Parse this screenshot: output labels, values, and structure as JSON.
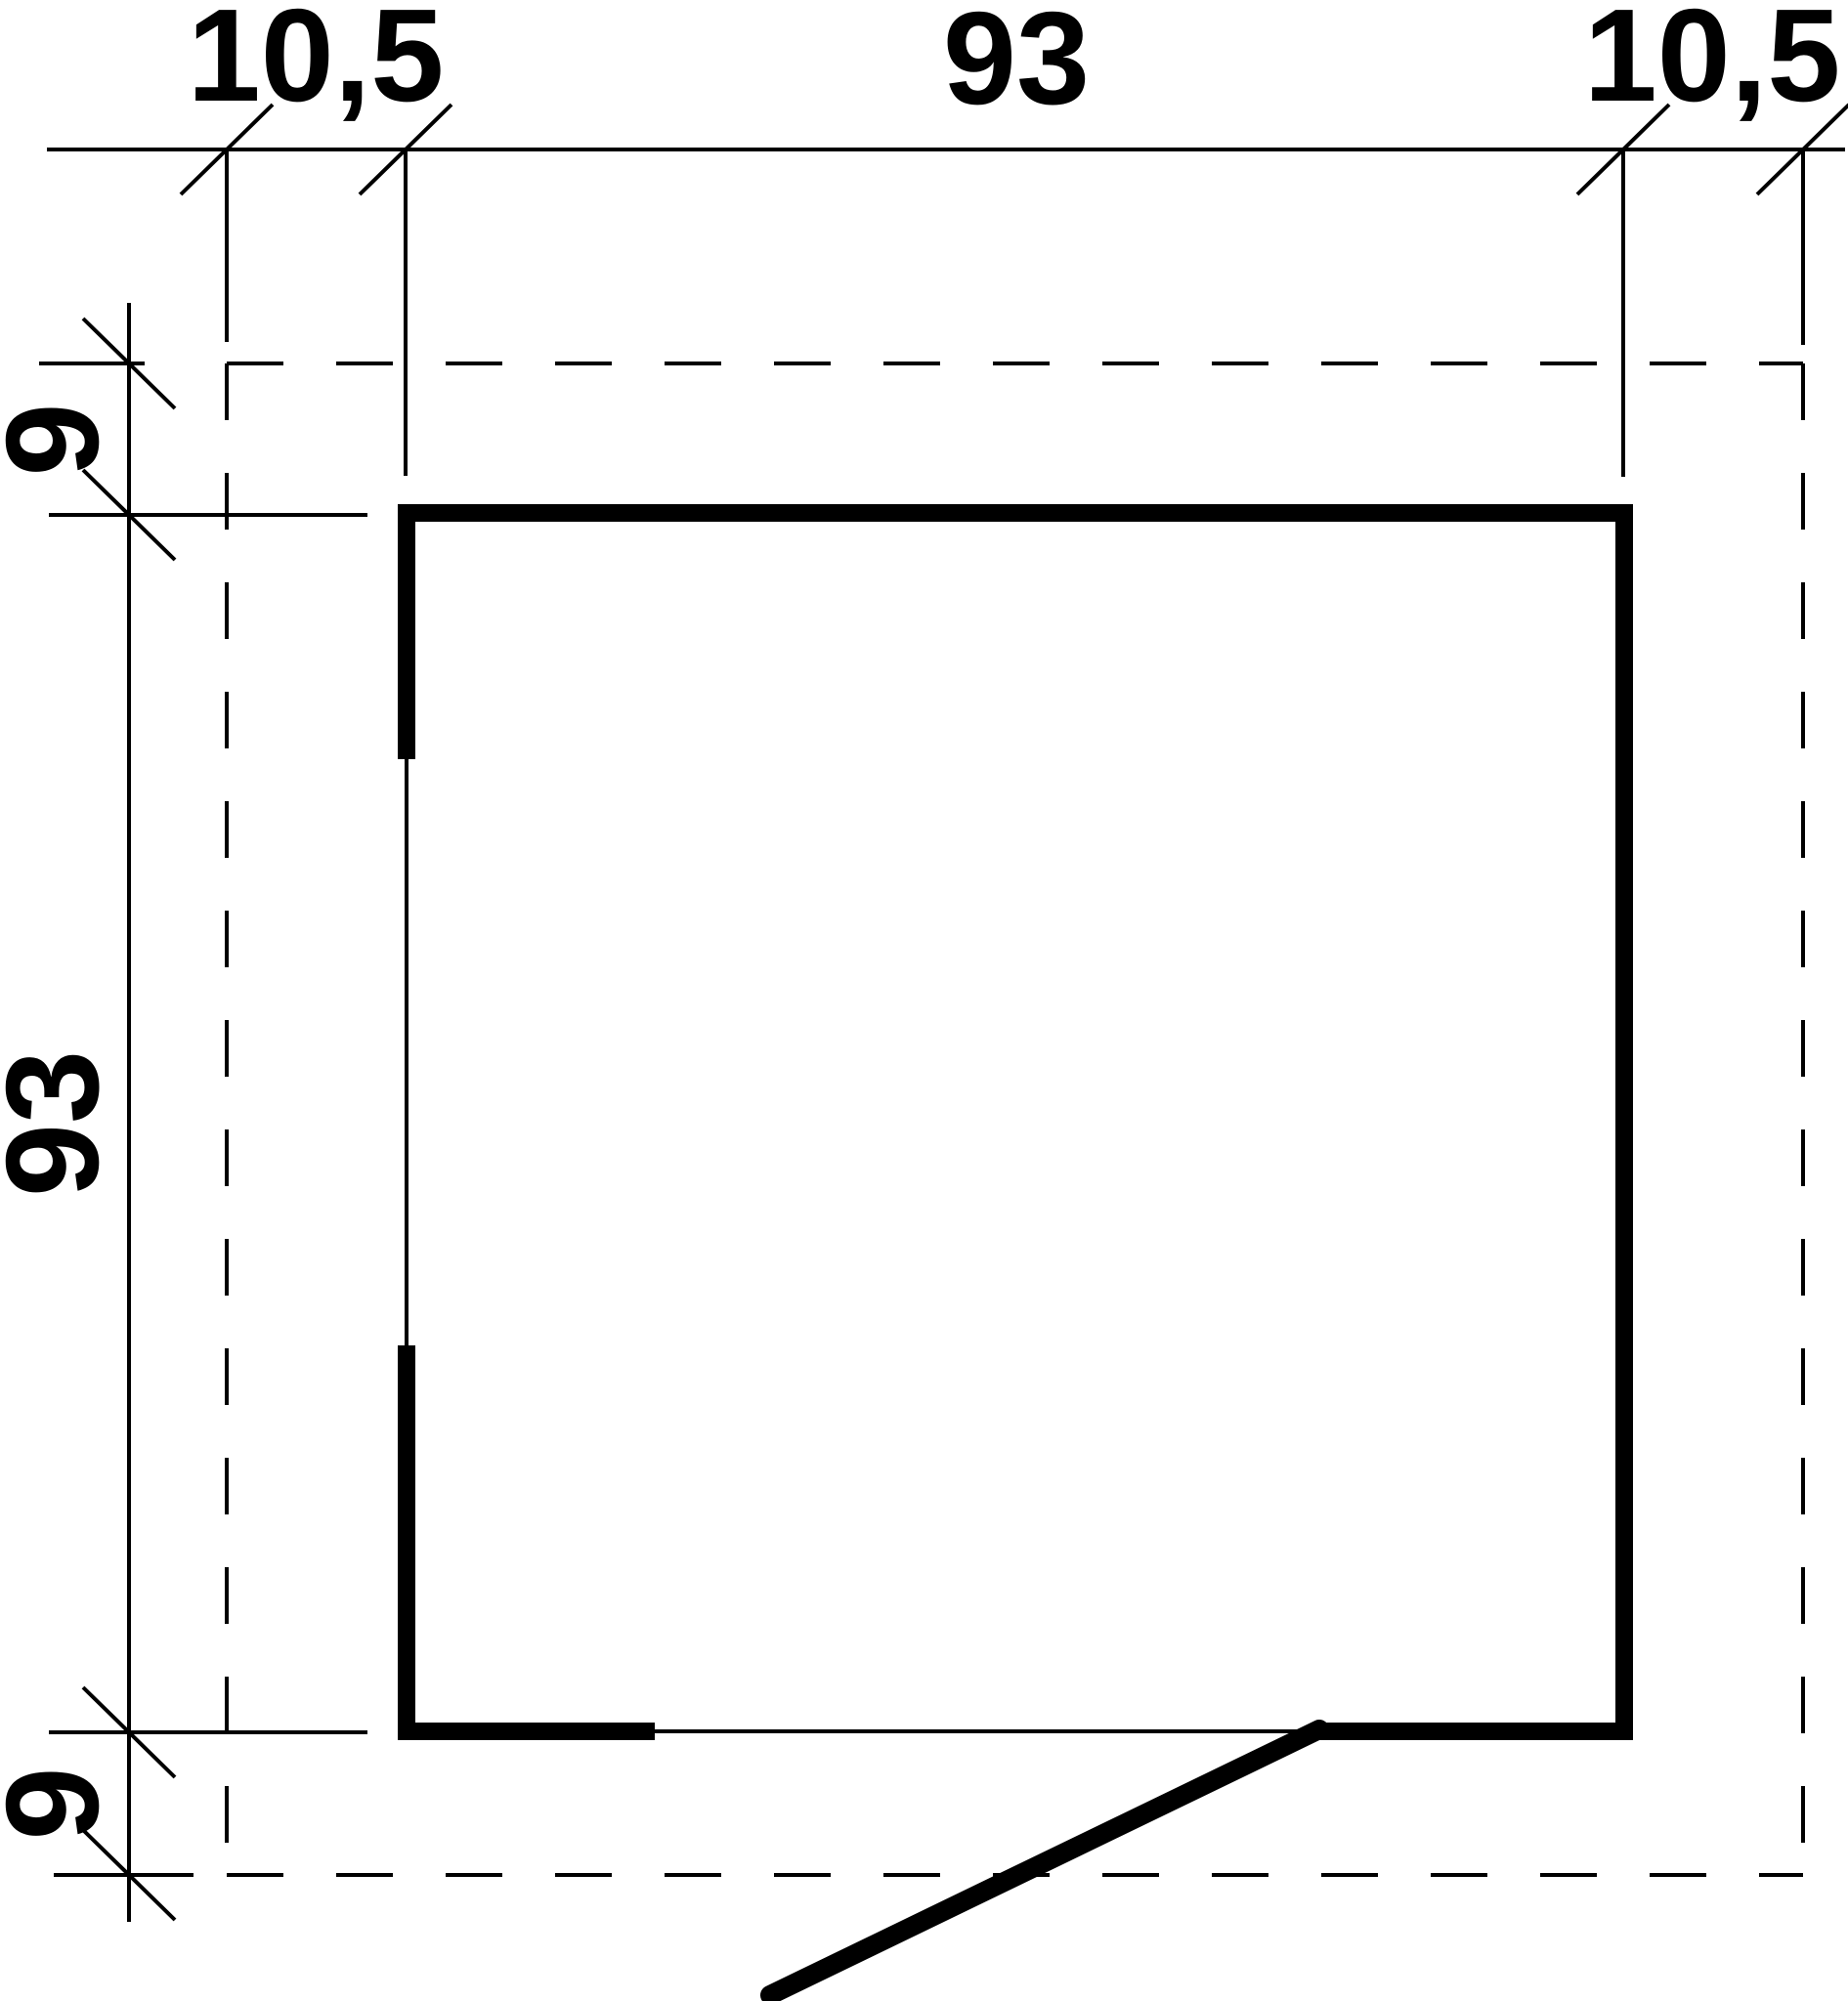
{
  "drawing": {
    "kind": "floor-plan-dimension-drawing",
    "colors": {
      "line": "#000000",
      "background": "#ffffff"
    },
    "dimension_labels": {
      "top_left": "10,5",
      "top_middle": "93",
      "top_right": "10,5",
      "left_top": "9",
      "left_middle": "93",
      "left_bottom": "9"
    }
  }
}
